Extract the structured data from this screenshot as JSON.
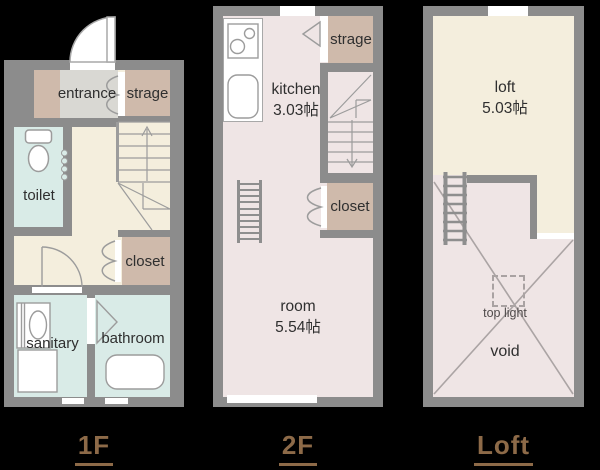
{
  "palette": {
    "background": "#000000",
    "wall_gray": "#8c8c8c",
    "cream_floor": "#f4eedd",
    "pink_floor": "#efe5e5",
    "wet_room_blue": "#d9ebe7",
    "entrance_gray": "#d9d8d3",
    "storage_brown": "#cfbaab",
    "floor_label_brown": "#8d6a48",
    "fixture_line_gray": "#9c9c9c",
    "room_text": "#2f2f2f"
  },
  "floor_1f": {
    "label": "1F",
    "entrance": "entrance",
    "strage": "strage",
    "toilet": "toilet",
    "closet": "closet",
    "sanitary": "sanitary",
    "bathroom": "bathroom"
  },
  "floor_2f": {
    "label": "2F",
    "kitchen": "kitchen",
    "kitchen_area": "3.03帖",
    "strage": "strage",
    "closet": "closet",
    "room": "room",
    "room_area": "5.54帖"
  },
  "floor_loft": {
    "label": "Loft",
    "loft": "loft",
    "loft_area": "5.03帖",
    "top_light": "top light",
    "void": "void"
  }
}
